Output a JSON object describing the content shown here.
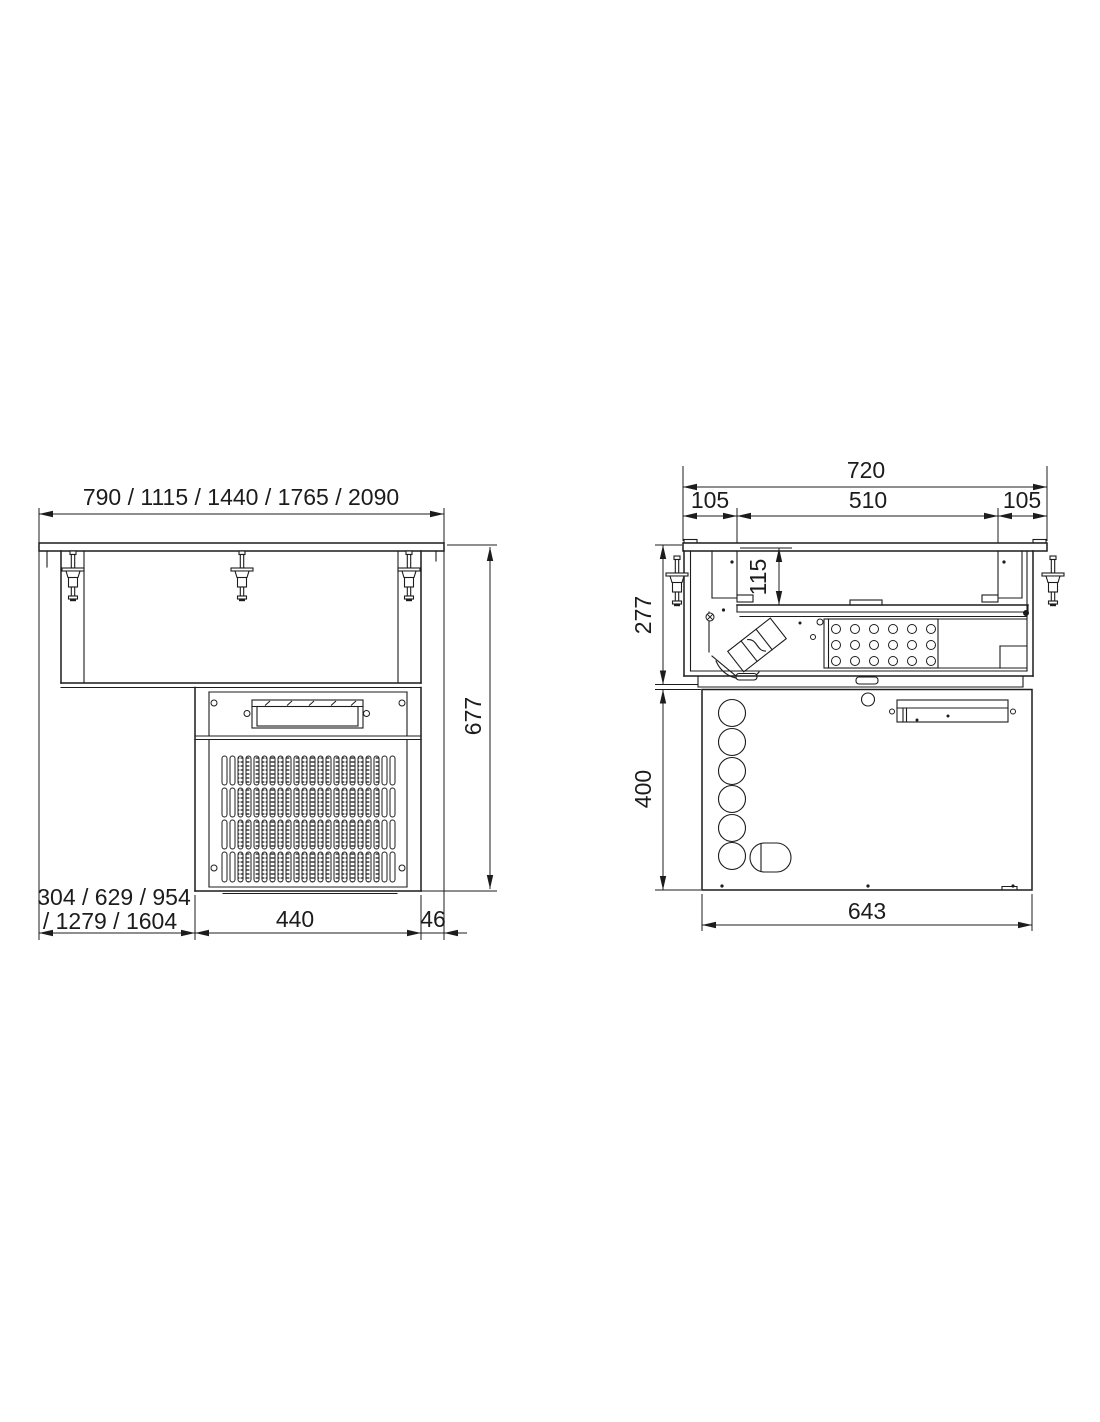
{
  "drawing": {
    "front_view": {
      "width_options": "790 / 1115 / 1440 / 1765 / 2090",
      "overall_height": "677",
      "offset_options_line1": "304 / 629 / 954",
      "offset_options_line2": "/ 1279 / 1604",
      "condensing_unit_width": "440",
      "side_gap": "46"
    },
    "side_view": {
      "total_depth": "720",
      "front_flange": "105",
      "well_opening": "510",
      "rear_flange": "105",
      "well_depth": "115",
      "upper_section_height": "277",
      "lower_section_height": "400",
      "lower_section_depth": "643"
    },
    "style": {
      "line_color": "#1c1c1c",
      "background": "#ffffff"
    }
  }
}
